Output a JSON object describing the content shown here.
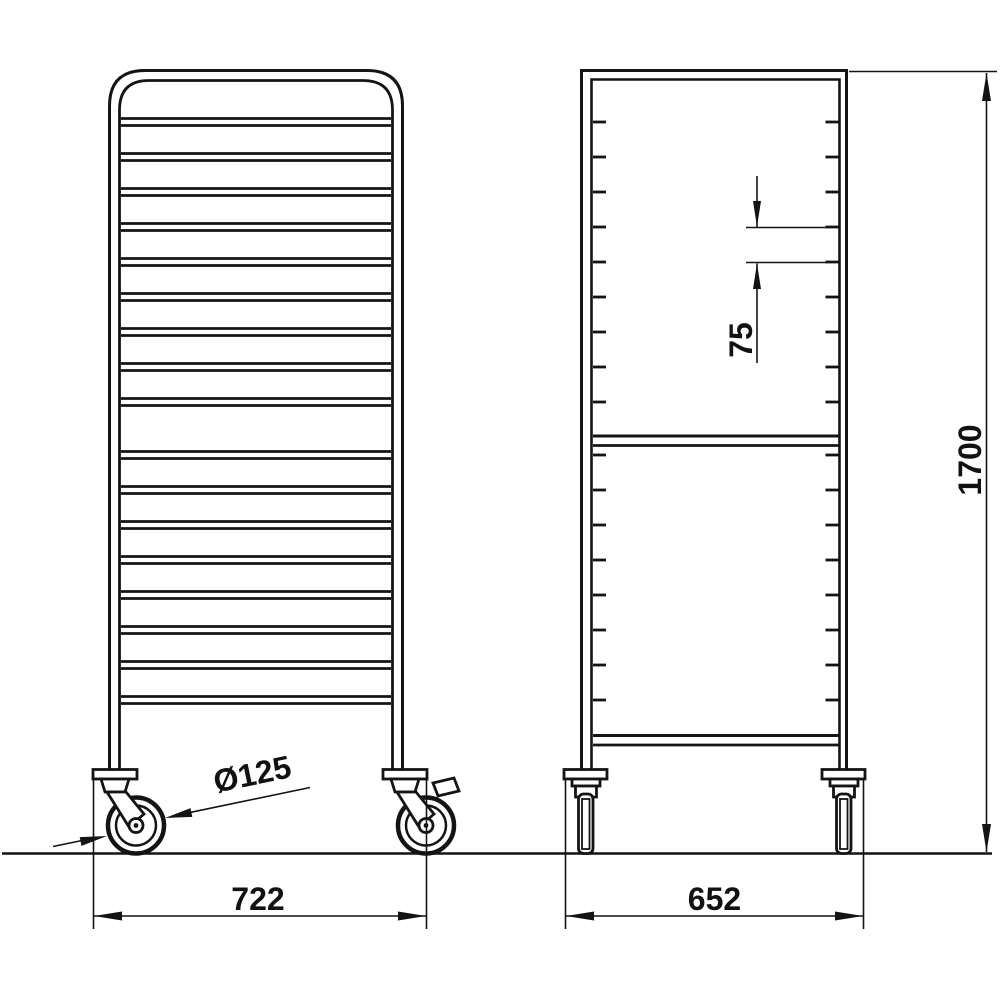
{
  "drawing": {
    "background": "#ffffff",
    "line_color": "#141414",
    "structure": {
      "front_rails_above_gap": 9,
      "front_rails_below_gap": 8,
      "side_ticks_above_crossbar": 9,
      "side_ticks_below_crossbar": 8
    },
    "dimensions": {
      "front_width": "722",
      "side_depth": "652",
      "overall_height": "1700",
      "rail_pitch": "75",
      "castor_diameter": "Ø125"
    }
  }
}
